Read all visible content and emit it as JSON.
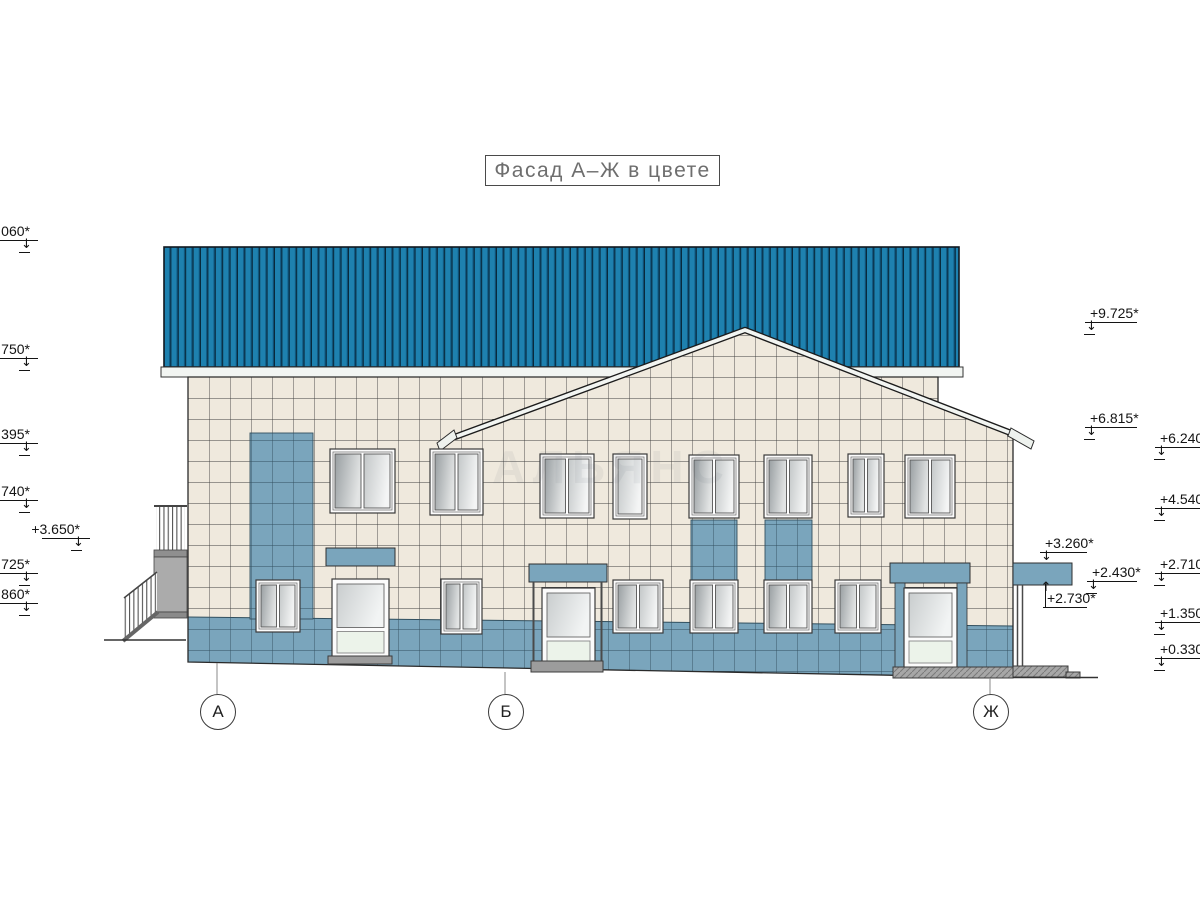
{
  "title": "Фасад А–Ж в цвете",
  "watermark": "АЛЬЯНС",
  "axis_markers": [
    "А",
    "Б",
    "Ж"
  ],
  "elevation_marks": {
    "left": [
      ".060*",
      ".750*",
      ".395*",
      ".740*",
      "+3.650*",
      ".725*",
      ".860*"
    ],
    "right": [
      "+9.725*",
      "+6.815*",
      "+6.240*",
      "+4.540*",
      "+3.260*",
      "+2.710*",
      "+2.430*",
      "+2.730*",
      "+1.350*",
      "+0.330*"
    ]
  },
  "colors": {
    "roof_blue": "#1e81af",
    "accent_blue": "#7aa5bc",
    "wall_cream": "#efe9dd",
    "steps_gray": "#a7a7a7"
  }
}
